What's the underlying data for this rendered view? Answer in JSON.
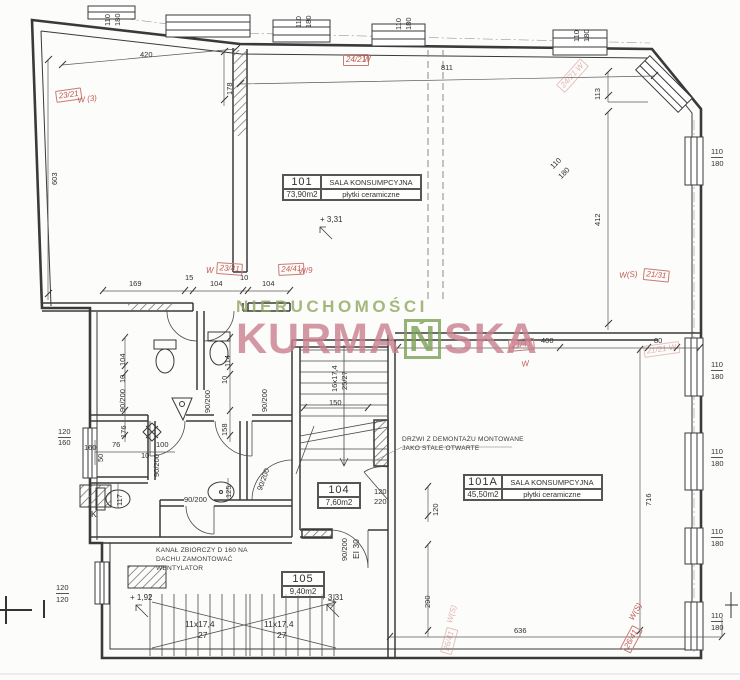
{
  "watermark": {
    "top": "NIERUCHOMOŚCI",
    "main_pre": "KURMA",
    "main_boxed": "Ń",
    "main_post": "SKA"
  },
  "rooms": {
    "r101": {
      "number": "101",
      "name": "SALA KONSUMPCYJNA",
      "area": "73,90m2",
      "floor": "płytki ceramiczne"
    },
    "r101a": {
      "number": "101A",
      "name": "SALA KONSUMPCYJNA",
      "area": "45,50m2",
      "floor": "płytki ceramiczne"
    },
    "r104": {
      "number": "104",
      "area": "7,60m2"
    },
    "r105": {
      "number": "105",
      "area": "9,40m2"
    }
  },
  "notes": {
    "door_line1": "DRZWI Z DEMONTAŻU MONTOWANE",
    "door_line2": "JAKO STALE OTWARTE",
    "duct_line1": "KANAŁ ZBIORCZY D 160 NA",
    "duct_line2": "DACHU ZAMONTOWAĆ",
    "duct_line3": "WENTYLATOR"
  },
  "levels": [
    {
      "t": "+ 3,31",
      "x": 320,
      "y": 215
    },
    {
      "t": "+ 1,92",
      "x": 130,
      "y": 593
    },
    {
      "t": "+ 3,31",
      "x": 321,
      "y": 593
    }
  ],
  "dimensions": [
    {
      "t": "420",
      "x": 140,
      "y": 51
    },
    {
      "t": "811",
      "x": 441,
      "y": 64
    },
    {
      "t": "113",
      "x": 594,
      "y": 100,
      "r": -90
    },
    {
      "t": "603",
      "x": 51,
      "y": 185,
      "r": -90
    },
    {
      "t": "178",
      "x": 226,
      "y": 95,
      "r": -90
    },
    {
      "t": "412",
      "x": 594,
      "y": 226,
      "r": -90
    },
    {
      "t": "169",
      "x": 129,
      "y": 280
    },
    {
      "t": "15",
      "x": 185,
      "y": 274
    },
    {
      "t": "104",
      "x": 210,
      "y": 280
    },
    {
      "t": "10",
      "x": 240,
      "y": 274
    },
    {
      "t": "104",
      "x": 262,
      "y": 280
    },
    {
      "t": "400",
      "x": 541,
      "y": 337
    },
    {
      "t": "80",
      "x": 654,
      "y": 337
    },
    {
      "t": "150",
      "x": 329,
      "y": 399
    },
    {
      "t": "120",
      "x": 374,
      "y": 488
    },
    {
      "t": "220",
      "x": 374,
      "y": 498
    },
    {
      "t": "120",
      "x": 432,
      "y": 516,
      "r": -90
    },
    {
      "t": "290",
      "x": 424,
      "y": 608,
      "r": -90
    },
    {
      "t": "716",
      "x": 645,
      "y": 506,
      "r": -90
    },
    {
      "t": "636",
      "x": 514,
      "y": 627
    },
    {
      "t": "104",
      "x": 119,
      "y": 366,
      "r": -90
    },
    {
      "t": "10",
      "x": 119,
      "y": 383,
      "r": -90
    },
    {
      "t": "90/200",
      "x": 119,
      "y": 412,
      "r": -90
    },
    {
      "t": "176",
      "x": 120,
      "y": 438,
      "r": -90
    },
    {
      "t": "114",
      "x": 224,
      "y": 367,
      "r": -90
    },
    {
      "t": "10",
      "x": 221,
      "y": 384,
      "r": -90
    },
    {
      "t": "90/200",
      "x": 204,
      "y": 413,
      "r": -90
    },
    {
      "t": "90/200",
      "x": 261,
      "y": 412,
      "r": -90
    },
    {
      "t": "158",
      "x": 221,
      "y": 436,
      "r": -90
    },
    {
      "t": "50",
      "x": 97,
      "y": 462,
      "r": -90
    },
    {
      "t": "160",
      "x": 84,
      "y": 444
    },
    {
      "t": "76",
      "x": 112,
      "y": 441
    },
    {
      "t": "100",
      "x": 156,
      "y": 441
    },
    {
      "t": "10",
      "x": 141,
      "y": 452
    },
    {
      "t": "90/200",
      "x": 153,
      "y": 477,
      "r": -90
    },
    {
      "t": "117",
      "x": 116,
      "y": 506,
      "r": -90
    },
    {
      "t": "125",
      "x": 225,
      "y": 498,
      "r": -90
    },
    {
      "t": "90/200",
      "x": 184,
      "y": 496
    },
    {
      "t": "90/200",
      "x": 256,
      "y": 489,
      "r": -70
    },
    {
      "t": "90/200",
      "x": 341,
      "y": 561,
      "r": -90
    },
    {
      "t": "EI 30",
      "x": 352,
      "y": 559,
      "r": -90,
      "cls": "big"
    },
    {
      "t": "120",
      "x": 58,
      "y": 428,
      "fr": true
    },
    {
      "t": "160",
      "x": 58,
      "y": 439
    },
    {
      "t": "120",
      "x": 56,
      "y": 584,
      "fr": true
    },
    {
      "t": "120",
      "x": 56,
      "y": 596
    },
    {
      "t": "110",
      "x": 711,
      "y": 148,
      "fr": true
    },
    {
      "t": "180",
      "x": 711,
      "y": 160
    },
    {
      "t": "110",
      "x": 711,
      "y": 361,
      "fr": true
    },
    {
      "t": "180",
      "x": 711,
      "y": 373
    },
    {
      "t": "110",
      "x": 711,
      "y": 448,
      "fr": true
    },
    {
      "t": "180",
      "x": 711,
      "y": 460
    },
    {
      "t": "110",
      "x": 711,
      "y": 528,
      "fr": true
    },
    {
      "t": "180",
      "x": 711,
      "y": 540
    },
    {
      "t": "110",
      "x": 711,
      "y": 612,
      "fr": true
    },
    {
      "t": "180",
      "x": 711,
      "y": 624
    },
    {
      "t": "110",
      "x": 104,
      "y": 26,
      "r": -90
    },
    {
      "t": "180",
      "x": 114,
      "y": 26,
      "r": -90
    },
    {
      "t": "110",
      "x": 295,
      "y": 28,
      "r": -90
    },
    {
      "t": "180",
      "x": 305,
      "y": 28,
      "r": -90
    },
    {
      "t": "110",
      "x": 395,
      "y": 30,
      "r": -90
    },
    {
      "t": "180",
      "x": 405,
      "y": 30,
      "r": -90
    },
    {
      "t": "110",
      "x": 573,
      "y": 42,
      "r": -90
    },
    {
      "t": "180",
      "x": 583,
      "y": 42,
      "r": -90
    },
    {
      "t": "110",
      "x": 549,
      "y": 165,
      "r": -45
    },
    {
      "t": "180",
      "x": 557,
      "y": 175,
      "r": -45
    },
    {
      "t": "K",
      "x": 91,
      "y": 510,
      "cls": "big"
    },
    {
      "t": "11x17,4",
      "x": 185,
      "y": 620,
      "cls": "big"
    },
    {
      "t": "27",
      "x": 198,
      "y": 631,
      "cls": "big"
    },
    {
      "t": "11x17,4",
      "x": 264,
      "y": 620,
      "cls": "big"
    },
    {
      "t": "27",
      "x": 277,
      "y": 631,
      "cls": "big"
    },
    {
      "t": "16x17,4",
      "x": 331,
      "y": 392,
      "r": -90
    },
    {
      "t": "25/27",
      "x": 341,
      "y": 390,
      "r": -90
    }
  ],
  "red_annotations": [
    {
      "t": "23/21",
      "x": 55,
      "y": 91,
      "r": -8,
      "box": true
    },
    {
      "t": "W (3)",
      "x": 77,
      "y": 97,
      "r": -8
    },
    {
      "t": "24/21",
      "x": 343,
      "y": 54,
      "box": true
    },
    {
      "t": "W",
      "x": 363,
      "y": 56
    },
    {
      "t": "W",
      "x": 206,
      "y": 267
    },
    {
      "t": "23/41",
      "x": 217,
      "y": 262,
      "r": 4,
      "box": true
    },
    {
      "t": "24/41",
      "x": 278,
      "y": 264,
      "r": -3,
      "box": true
    },
    {
      "t": "W/9",
      "x": 298,
      "y": 268,
      "r": -6
    },
    {
      "t": "24/21 W",
      "x": 556,
      "y": 85,
      "r": -48,
      "box": true,
      "faint": true
    },
    {
      "t": "W(S)",
      "x": 619,
      "y": 272,
      "r": -5
    },
    {
      "t": "21/31",
      "x": 644,
      "y": 268,
      "r": 6,
      "box": true
    },
    {
      "t": "21/41",
      "x": 508,
      "y": 340,
      "r": -5,
      "box": true
    },
    {
      "t": "W",
      "x": 521,
      "y": 361,
      "r": -10
    },
    {
      "t": "21/21 W",
      "x": 643,
      "y": 346,
      "r": -8,
      "faint": true,
      "box": true
    },
    {
      "t": "W(S)",
      "x": 628,
      "y": 618,
      "r": -62
    },
    {
      "t": "26/41",
      "x": 620,
      "y": 648,
      "r": -62,
      "box": true
    },
    {
      "t": "W(S)",
      "x": 446,
      "y": 622,
      "r": -75,
      "faint": true
    },
    {
      "t": "26/41",
      "x": 440,
      "y": 652,
      "r": -75,
      "box": true,
      "faint": true
    }
  ]
}
